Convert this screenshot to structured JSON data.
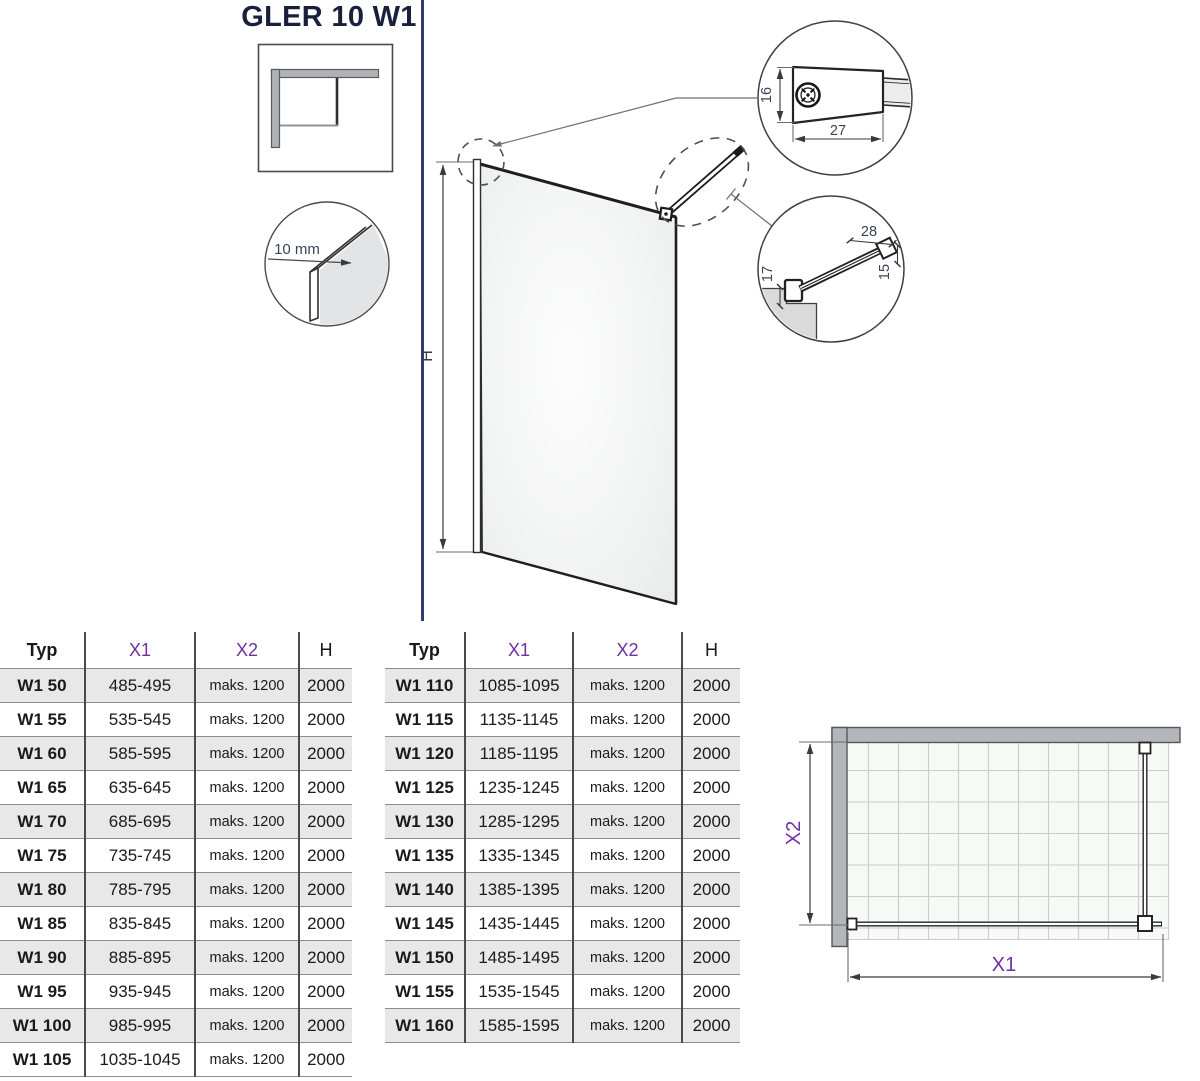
{
  "title": "GLER 10 W1",
  "colors": {
    "accent_purple": "#7030a0",
    "divider_navy": "#2e3c6f",
    "row_shade": "#e8e8e8"
  },
  "drawing": {
    "height_label": "H",
    "glass_thickness": "10 mm",
    "bracket_detail": {
      "height": "16",
      "depth": "27"
    },
    "arm_detail": {
      "length": "28",
      "height": "15",
      "offset": "17"
    }
  },
  "plan": {
    "width_label": "X1",
    "depth_label": "X2"
  },
  "table": {
    "headers": {
      "typ": "Typ",
      "x1": "X1",
      "x2": "X2",
      "h": "H"
    },
    "left_rows": [
      [
        "W1 50",
        "485-495",
        "maks. 1200",
        "2000"
      ],
      [
        "W1 55",
        "535-545",
        "maks. 1200",
        "2000"
      ],
      [
        "W1 60",
        "585-595",
        "maks. 1200",
        "2000"
      ],
      [
        "W1 65",
        "635-645",
        "maks. 1200",
        "2000"
      ],
      [
        "W1 70",
        "685-695",
        "maks. 1200",
        "2000"
      ],
      [
        "W1 75",
        "735-745",
        "maks. 1200",
        "2000"
      ],
      [
        "W1 80",
        "785-795",
        "maks. 1200",
        "2000"
      ],
      [
        "W1 85",
        "835-845",
        "maks. 1200",
        "2000"
      ],
      [
        "W1 90",
        "885-895",
        "maks. 1200",
        "2000"
      ],
      [
        "W1 95",
        "935-945",
        "maks. 1200",
        "2000"
      ],
      [
        "W1 100",
        "985-995",
        "maks. 1200",
        "2000"
      ],
      [
        "W1 105",
        "1035-1045",
        "maks. 1200",
        "2000"
      ]
    ],
    "right_rows": [
      [
        "W1 110",
        "1085-1095",
        "maks. 1200",
        "2000"
      ],
      [
        "W1 115",
        "1135-1145",
        "maks. 1200",
        "2000"
      ],
      [
        "W1 120",
        "1185-1195",
        "maks. 1200",
        "2000"
      ],
      [
        "W1 125",
        "1235-1245",
        "maks. 1200",
        "2000"
      ],
      [
        "W1 130",
        "1285-1295",
        "maks. 1200",
        "2000"
      ],
      [
        "W1 135",
        "1335-1345",
        "maks. 1200",
        "2000"
      ],
      [
        "W1 140",
        "1385-1395",
        "maks. 1200",
        "2000"
      ],
      [
        "W1 145",
        "1435-1445",
        "maks. 1200",
        "2000"
      ],
      [
        "W1 150",
        "1485-1495",
        "maks. 1200",
        "2000"
      ],
      [
        "W1 155",
        "1535-1545",
        "maks. 1200",
        "2000"
      ],
      [
        "W1 160",
        "1585-1595",
        "maks. 1200",
        "2000"
      ]
    ]
  }
}
